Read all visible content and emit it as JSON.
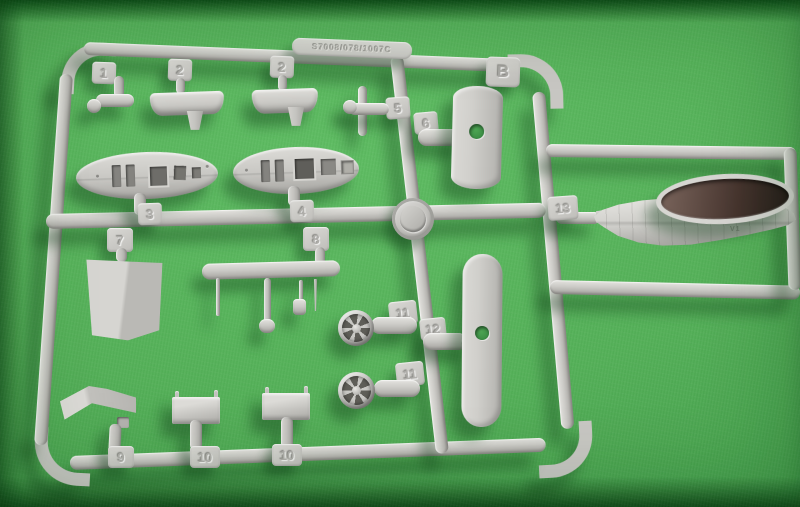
{
  "scene": {
    "description": "Photograph of a light-grey injection-moulded model kit sprue (runner B) with numbered parts, lying on green felt",
    "felt_color": "#54b058",
    "plastic_color": "#cbcac6",
    "shadow_color": "#0c3a14"
  },
  "sprue": {
    "runner_letter": "B",
    "embossed_code": "S7008/078/1007C",
    "hull_marking": "V1",
    "part_tags": [
      {
        "label": "1"
      },
      {
        "label": "2"
      },
      {
        "label": "2"
      },
      {
        "label": "5"
      },
      {
        "label": "6"
      },
      {
        "label": "3"
      },
      {
        "label": "4"
      },
      {
        "label": "13"
      },
      {
        "label": "7"
      },
      {
        "label": "8"
      },
      {
        "label": "11"
      },
      {
        "label": "12"
      },
      {
        "label": "11"
      },
      {
        "label": "9"
      },
      {
        "label": "10"
      },
      {
        "label": "10"
      }
    ]
  }
}
